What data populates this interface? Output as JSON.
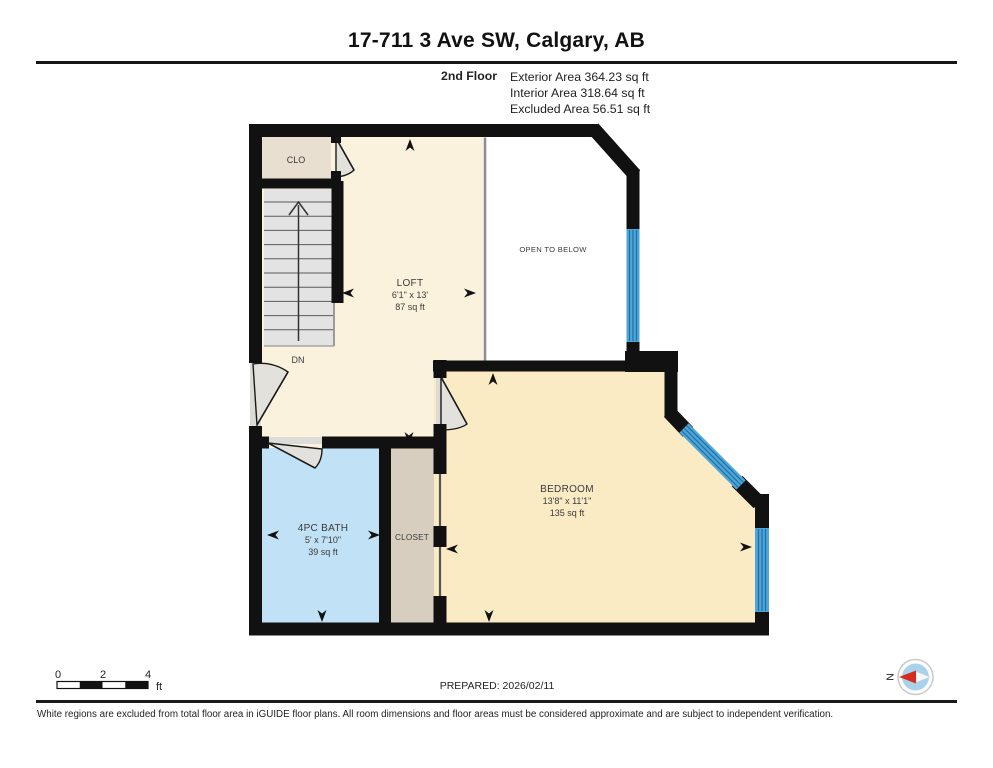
{
  "header": {
    "title": "17-711 3 Ave SW, Calgary, AB",
    "floor_label": "2nd Floor",
    "area_lines": [
      "Exterior Area 364.23 sq ft",
      "Interior Area 318.64 sq ft",
      "Excluded Area 56.51 sq ft"
    ]
  },
  "rooms": {
    "loft": {
      "name": "LOFT",
      "dimensions": "6'1\" x 13'",
      "area": "87 sq ft"
    },
    "bedroom": {
      "name": "BEDROOM",
      "dimensions": "13'8\" x 11'1\"",
      "area": "135 sq ft"
    },
    "bath": {
      "name": "4PC BATH",
      "dimensions": "5' x 7'10\"",
      "area": "39 sq ft"
    },
    "closet": {
      "name": "CLOSET"
    },
    "clo": {
      "name": "CLO"
    },
    "open_to_below": {
      "name": "OPEN TO BELOW"
    },
    "stairs": {
      "direction_label": "DN"
    }
  },
  "scale_bar": {
    "ticks": [
      "0",
      "2",
      "4"
    ],
    "unit": "ft"
  },
  "compass": {
    "north_label": "N"
  },
  "footer": {
    "prepared": "PREPARED: 2026/02/11",
    "disclaimer": "White regions are excluded from total floor area in iGUIDE floor plans. All room dimensions and floor areas must be considered approximate and are subject to independent verification."
  },
  "colors": {
    "wall": "#111111",
    "window_blue": "#4EA5D8",
    "window_line": "#1E6FA3",
    "loft_floor": "#FAF2DC",
    "bedroom_floor": "#FBEBC5",
    "bath_floor": "#C1E2F6",
    "closet_floor": "#D8CEC0",
    "clo_floor": "#E9DFD1",
    "stairs_fill": "#E3E3E3",
    "compass_red": "#D62B1F",
    "compass_blue": "#A9D3EB"
  }
}
